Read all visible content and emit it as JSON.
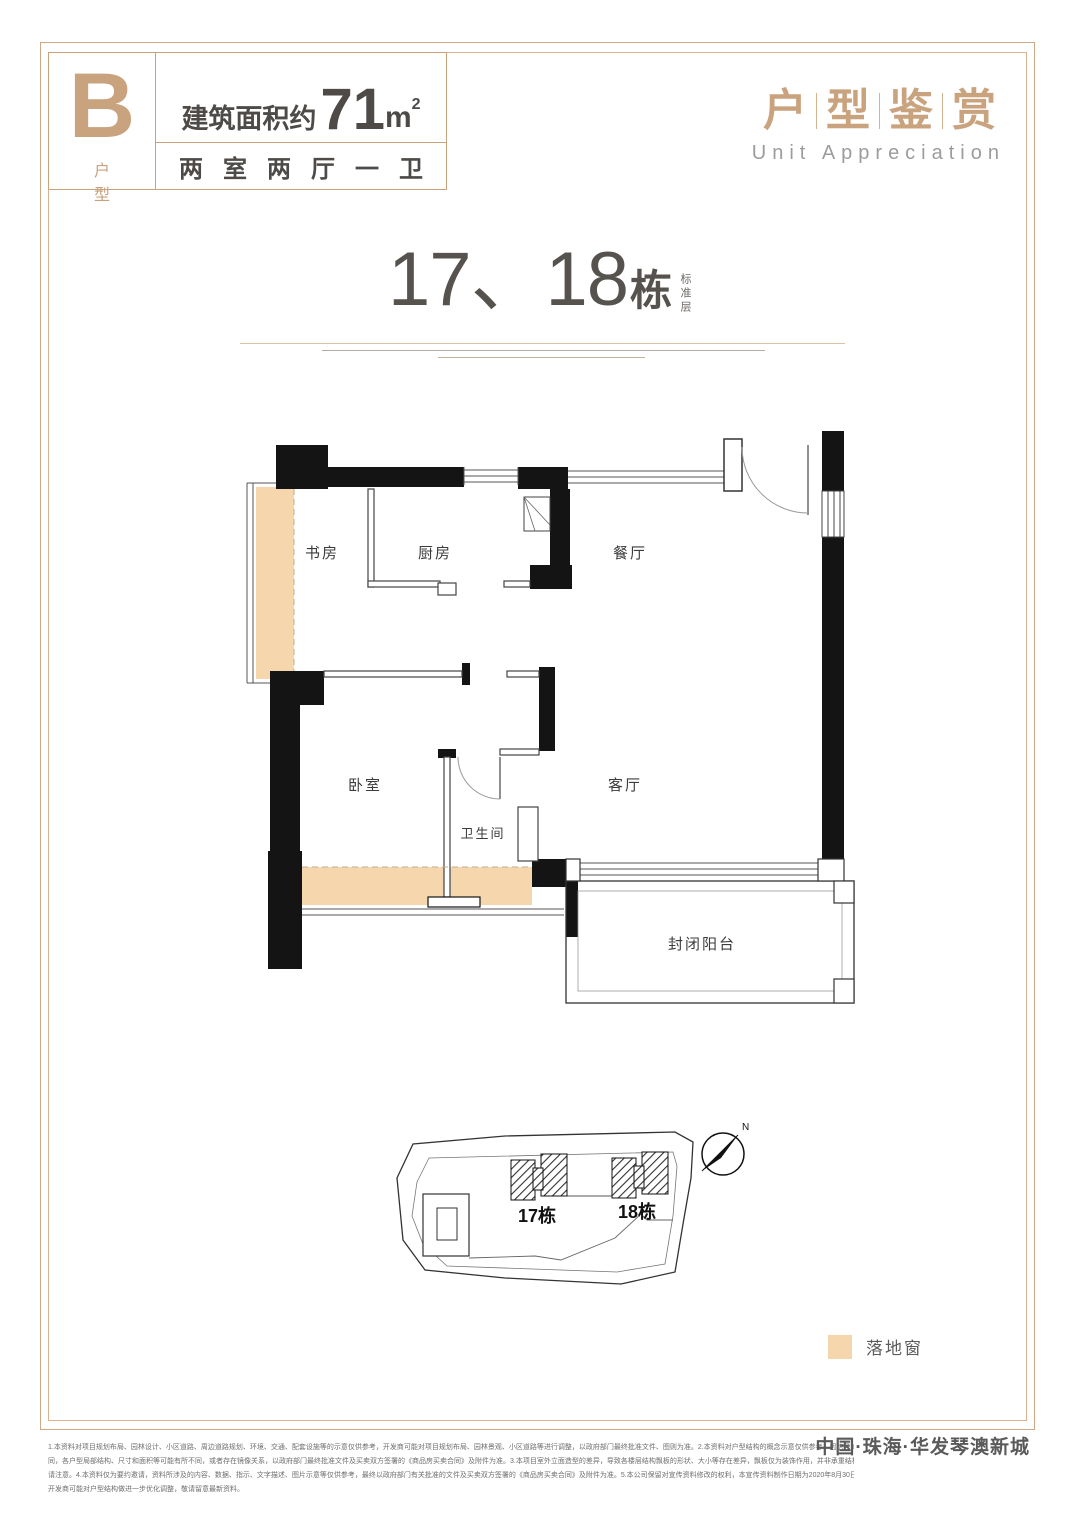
{
  "header": {
    "unit_letter": "B",
    "unit_label": "户 型",
    "area_prefix": "建筑面积约",
    "area_value": "71",
    "area_unit": "m",
    "area_unit_sup": "2",
    "layout": "两室两厅一卫"
  },
  "brand_block": {
    "chars": [
      "户",
      "型",
      "鉴",
      "赏"
    ],
    "subtitle": "Unit Appreciation"
  },
  "title": {
    "number": "17、18",
    "suffix": "栋",
    "floor_tag": "标准层"
  },
  "plan": {
    "rooms": {
      "study": "书房",
      "kitchen": "厨房",
      "dining": "餐厅",
      "bedroom": "卧室",
      "bathroom": "卫生间",
      "living": "客厅",
      "balcony": "封闭阳台"
    }
  },
  "site": {
    "building17": "17栋",
    "building18": "18栋",
    "north": "N"
  },
  "legend": {
    "swatch_color": "#f5d6ad",
    "label": "落地窗"
  },
  "footer": {
    "disclaimer_lines": [
      "1.本资料对项目规划布局、园林设计、小区道路、周边道路规划、环境、交通、配套设施等的示意仅供参考，开发商可能对项目规划布局、园林景观、小区道路等进行调整，以政府部门最终批准文件、图则为准。2.本资料对户型结构的概念示意仅供参考，因房号的不",
      "同，各户型局部结构、尺寸和面积等可能有所不同，或者存在镜像关系，以政府部门最终批准文件及买卖双方签署的《商品房买卖合同》及附件为准。3.本项目室外立面造型的差异，导致各楼层结构飘板的形状、大小等存在差异，飘板仅为装饰作用，并非承重结构，敬",
      "请注意。4.本资料仅为要约邀请，资料所涉及的内容、数据、指示、文字描述、图片示意等仅供参考，最终以政府部门有关批准的文件及买卖双方签署的《商品房买卖合同》及附件为准。5.本公司保留对宣传资料修改的权利，本宣传资料制作日期为2020年8月30日，",
      "开发商可能对户型结构做进一步优化调整，敬请留意最新资料。"
    ],
    "brand": "中国·珠海·华发琴澳新城"
  },
  "colors": {
    "accent": "#c9a27e",
    "wall": "#141414",
    "window_fill": "#f5d6ad",
    "text_dark": "#56524d"
  }
}
